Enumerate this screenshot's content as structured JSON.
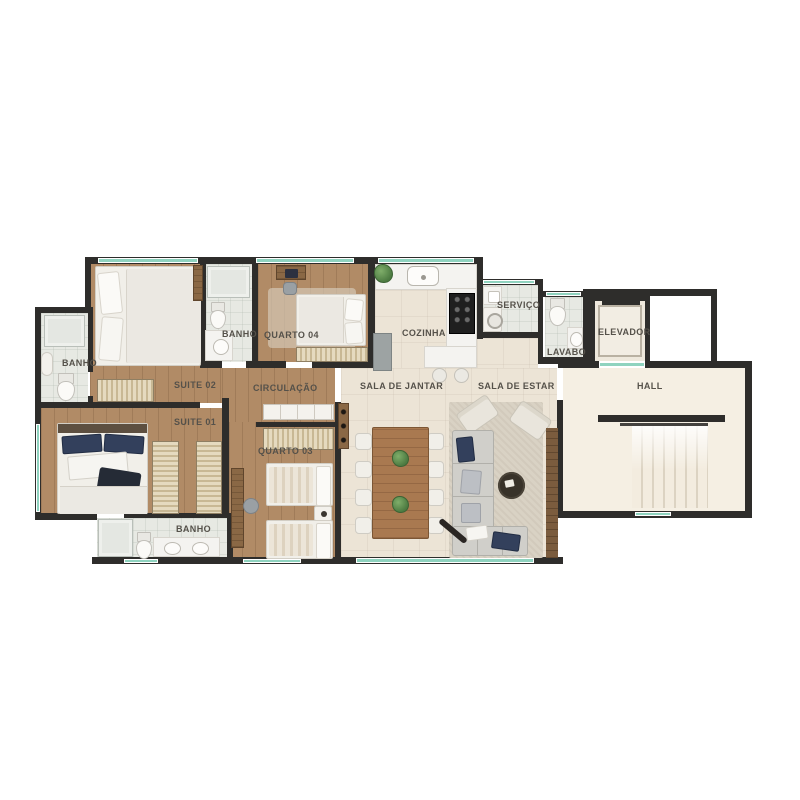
{
  "plan": {
    "type": "apartment-floor-plan",
    "rooms": {
      "banho_left": {
        "label": "BANHO"
      },
      "suite_02": {
        "label": "SUITE 02"
      },
      "banho_suite_02": {
        "label": "BANHO"
      },
      "quarto_04": {
        "label": "QUARTO 04"
      },
      "cozinha": {
        "label": "COZINHA"
      },
      "servico": {
        "label": "SERVIÇO"
      },
      "lavabo": {
        "label": "LAVABO"
      },
      "elevador": {
        "label": "ELEVADOR"
      },
      "hall": {
        "label": "HALL"
      },
      "sala_de_jantar": {
        "label": "SALA DE JANTAR"
      },
      "sala_de_estar": {
        "label": "SALA DE ESTAR"
      },
      "circulacao": {
        "label": "CIRCULAÇÃO"
      },
      "suite_01": {
        "label": "SUITE 01"
      },
      "quarto_03": {
        "label": "QUARTO 03"
      },
      "banho_suite_01": {
        "label": "BANHO"
      }
    },
    "palette": {
      "wall": "#2e2d2b",
      "wood_floor": "#b18b66",
      "tile_floor": "#ece4d6",
      "bath_floor": "#e7e9e3",
      "hall_floor": "#f5efe3",
      "window": "#8fd3bf",
      "label_text": "#55514a",
      "pillow_accent": "#33405c"
    }
  }
}
